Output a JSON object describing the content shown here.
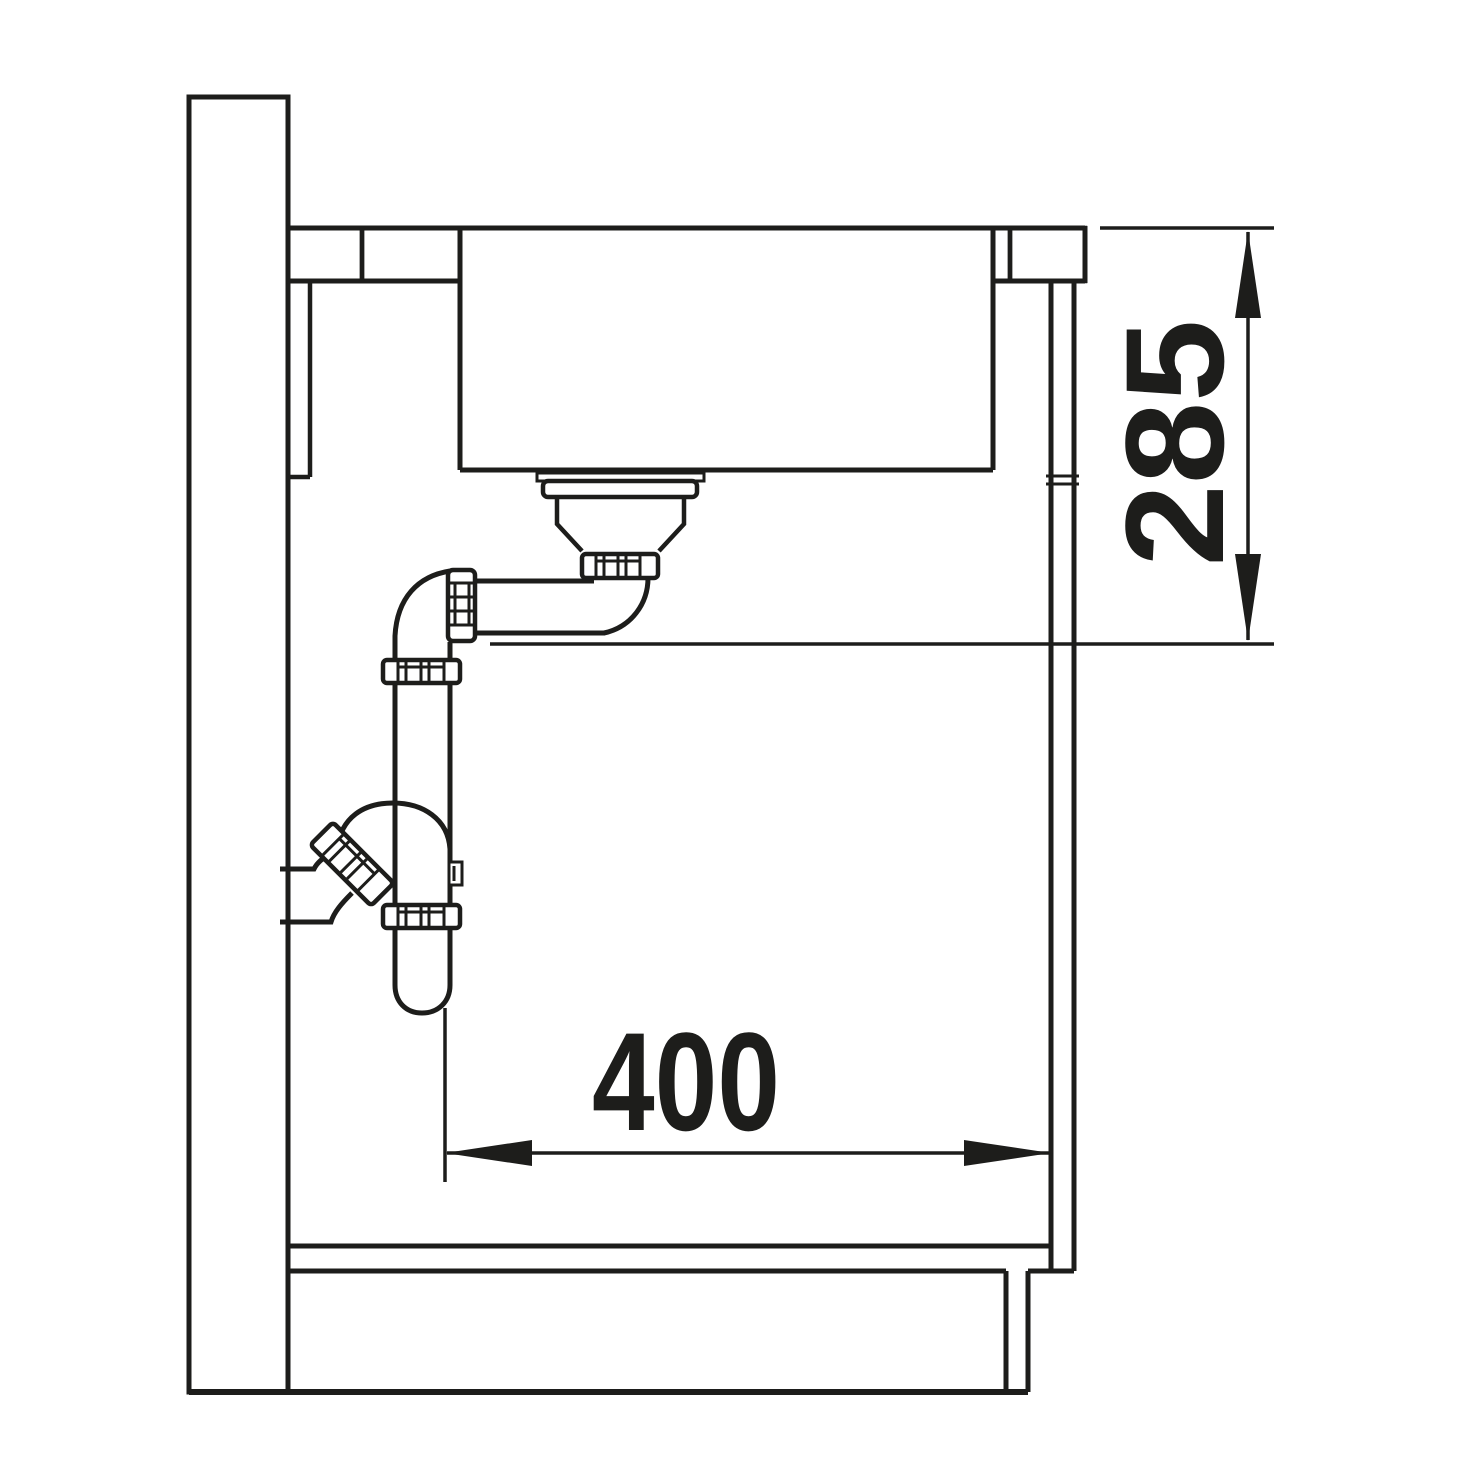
{
  "canvas": {
    "width": 1464,
    "height": 1464,
    "background": "#ffffff",
    "line_color": "#1d1d1b"
  },
  "drawing": {
    "kind": "sink-installation-section-drawing",
    "subject": "undermount kitchen sink with drain trap in base cabinet, side section view",
    "labels": {
      "vertical_dimension": "285",
      "horizontal_dimension": "400"
    }
  }
}
